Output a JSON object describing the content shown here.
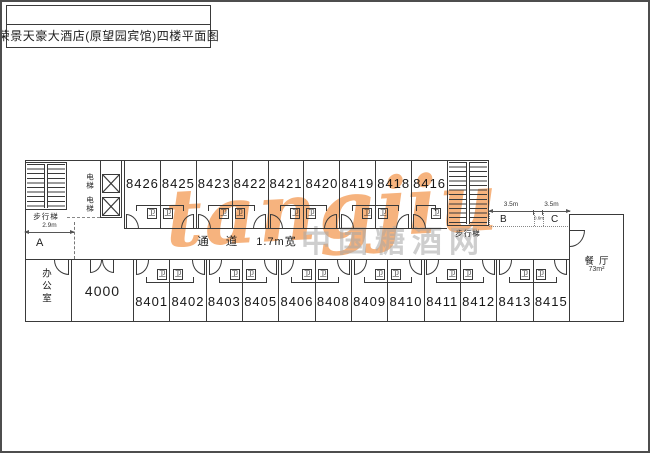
{
  "title": "荣景天豪大酒店(原望园宾馆)四楼平面图",
  "plan": {
    "top_rooms": [
      "8426",
      "8425",
      "8423",
      "8422",
      "8421",
      "8420",
      "8419",
      "8418",
      "8416"
    ],
    "bottom_rooms": [
      "8401",
      "8402",
      "8403",
      "8405",
      "8406",
      "8408",
      "8409",
      "8410",
      "8411",
      "8412",
      "8413",
      "8415"
    ],
    "office_label": "办公室",
    "room_4000_label": "4000",
    "dining": {
      "label": "餐厅",
      "area": "73m²"
    },
    "corridor": {
      "label": "通道",
      "width_note": "1.7m宽"
    },
    "elevator_label": "电梯",
    "stairs_label": "步行梯",
    "bathroom_label": "卫",
    "dims": {
      "left": "2.9m",
      "right_first": "3.5m",
      "right_second": "3.5m",
      "small": "0.6m"
    },
    "zones": {
      "a": "A",
      "b": "B",
      "c": "C"
    }
  },
  "watermark": {
    "logo_text": "tangjiu",
    "site_text": "中国糖酒网",
    "orange_color": "#f29e5a",
    "gray_color": "#a5a5a5"
  }
}
